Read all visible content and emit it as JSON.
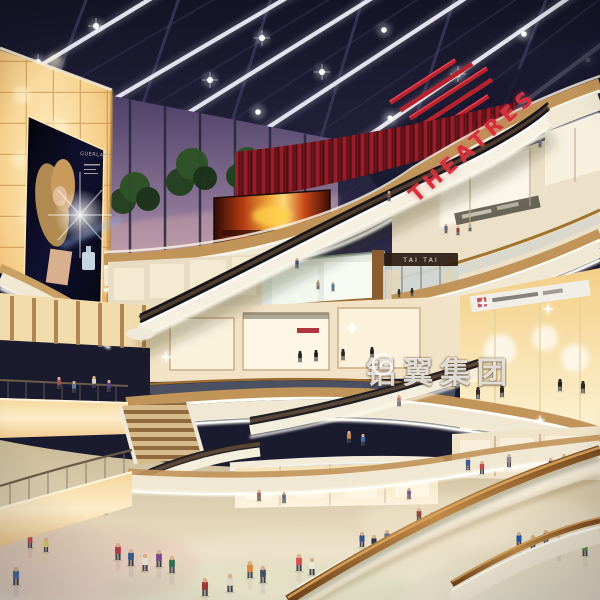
{
  "meta": {
    "type": "architectural-rendering",
    "subject": "Multi-level shopping mall atrium interior at evening, skylight ceiling, curved balcony fascias, escalators and shoppers"
  },
  "signs": {
    "theatres": "THEATRES",
    "tai_tai": "TAI TAI",
    "billboard_brand": "GUERLAIN",
    "watermark_text": "铝翼集团"
  },
  "palette": {
    "ceiling_navy": "#1b1b30",
    "dusk_sky": "#7d6a8c",
    "amber_wall": "#f6cf8a",
    "red_accent": "#c02432",
    "fascia_cream": "#f1e8d4",
    "wood_trim": "#c1945a",
    "floor_beige": "#e2d5b8",
    "handrail_wood": "#a9692f",
    "fire_screen_orange": "#f3a93c"
  },
  "people": [
    [
      118,
      560,
      17,
      "#b03a4a"
    ],
    [
      131,
      566,
      17,
      "#3a5a8c"
    ],
    [
      145,
      571,
      17,
      "#e7e0d2"
    ],
    [
      159,
      567,
      17,
      "#7a4a8c"
    ],
    [
      172,
      573,
      17,
      "#2f6e4f"
    ],
    [
      205,
      596,
      18,
      "#a03636"
    ],
    [
      230,
      592,
      18,
      "#ddd6c8"
    ],
    [
      250,
      578,
      17,
      "#d8883a"
    ],
    [
      263,
      583,
      17,
      "#44506a"
    ],
    [
      299,
      571,
      17,
      "#d94f4f"
    ],
    [
      312,
      575,
      17,
      "#ece6da"
    ],
    [
      362,
      547,
      15,
      "#33568a"
    ],
    [
      374,
      550,
      15,
      "#2e3448"
    ],
    [
      387,
      545,
      15,
      "#5a6f8a"
    ],
    [
      419,
      522,
      14,
      "#8c4a3a"
    ],
    [
      432,
      526,
      14,
      "#3a7a5a"
    ],
    [
      519,
      547,
      15,
      "#2456a0"
    ],
    [
      533,
      550,
      15,
      "#c9c4b8"
    ],
    [
      546,
      545,
      15,
      "#993d3d"
    ],
    [
      559,
      551,
      15,
      "#363650"
    ],
    [
      585,
      556,
      16,
      "#5a8c4a"
    ],
    [
      16,
      585,
      18,
      "#4a6fa5"
    ],
    [
      30,
      548,
      14,
      "#c05050"
    ],
    [
      46,
      552,
      14,
      "#d8c860"
    ],
    [
      63,
      509,
      13,
      "#5566aa"
    ],
    [
      77,
      513,
      13,
      "#c59a8a"
    ],
    [
      91,
      508,
      13,
      "#47684a"
    ],
    [
      105,
      514,
      13,
      "#9a70b8"
    ],
    [
      468,
      470,
      13,
      "#3a5a9a"
    ],
    [
      482,
      474,
      13,
      "#c04848"
    ],
    [
      509,
      467,
      13,
      "#8a8a92"
    ],
    [
      551,
      471,
      13,
      "#2e2e40"
    ],
    [
      564,
      467,
      13,
      "#56a0a8"
    ],
    [
      259,
      501,
      11,
      "#96645a"
    ],
    [
      284,
      503,
      11,
      "#5a6a8a"
    ],
    [
      409,
      499,
      11,
      "#7a5a92"
    ],
    [
      349,
      443,
      12,
      "#c08a5a"
    ],
    [
      363,
      446,
      12,
      "#4470a8"
    ],
    [
      59,
      389,
      12,
      "#a05050"
    ],
    [
      74,
      393,
      12,
      "#60789a"
    ],
    [
      94,
      388,
      12,
      "#d8d2c4"
    ],
    [
      109,
      392,
      12,
      "#50487e"
    ],
    [
      446,
      233,
      9,
      "#56688a"
    ],
    [
      458,
      235,
      9,
      "#94403a"
    ],
    [
      470,
      231,
      9,
      "#b8b2a6"
    ],
    [
      318,
      289,
      9,
      "#a8887a"
    ],
    [
      333,
      291,
      9,
      "#5a78a0"
    ],
    [
      297,
      268,
      10,
      "#44506a"
    ],
    [
      389,
      201,
      10,
      "#8a5a50"
    ],
    [
      540,
      147,
      9,
      "#5a6a8a"
    ],
    [
      399,
      406,
      11,
      "#c07878"
    ],
    [
      300,
      362,
      11,
      "#262320",
      "#262320"
    ],
    [
      316,
      361,
      11,
      "#1f1c1a",
      "#1f1c1a"
    ],
    [
      343,
      360,
      11,
      "#2a2622",
      "#2a2622"
    ],
    [
      372,
      358,
      11,
      "#232020",
      "#232020"
    ],
    [
      399,
      297,
      8,
      "#2e2a26",
      "#2e2a26"
    ],
    [
      412,
      296,
      8,
      "#26221e",
      "#26221e"
    ],
    [
      478,
      399,
      12,
      "#332e28",
      "#332e28"
    ],
    [
      502,
      397,
      12,
      "#2b2723",
      "#2b2723"
    ],
    [
      560,
      391,
      12,
      "#262320",
      "#262320"
    ],
    [
      583,
      393,
      12,
      "#2e2a24",
      "#2e2a24"
    ]
  ]
}
